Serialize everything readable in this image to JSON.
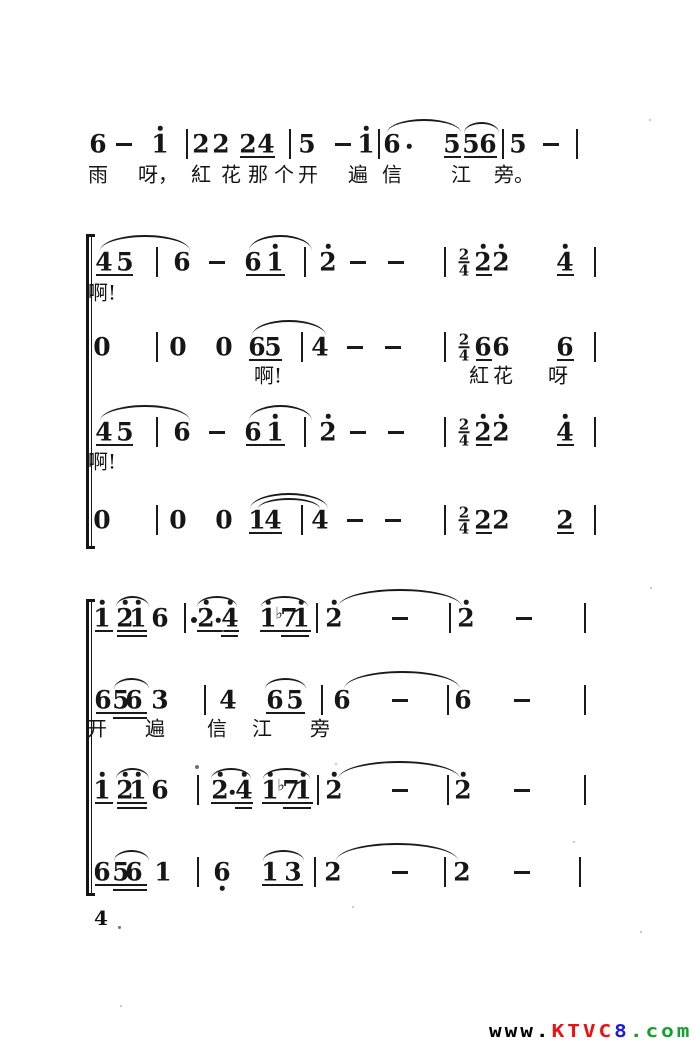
{
  "page": {
    "number": "4"
  },
  "colors": {
    "ink": "#1a1a1a",
    "paper": "#ffffff"
  },
  "watermark": {
    "segments": [
      {
        "text": "www.",
        "color": "#000000"
      },
      {
        "text": "KTVC",
        "color": "#ee1010"
      },
      {
        "text": "8",
        "color": "#1d1dd8"
      },
      {
        "text": ".com",
        "color": "#12a12e"
      }
    ]
  },
  "specks": [
    [
      118,
      926,
      3
    ],
    [
      195,
      765,
      4
    ],
    [
      649,
      119,
      2
    ],
    [
      335,
      763,
      2
    ],
    [
      650,
      587,
      2
    ],
    [
      222,
      630,
      2
    ],
    [
      352,
      906,
      2
    ],
    [
      573,
      841,
      2
    ],
    [
      120,
      1005,
      2
    ],
    [
      640,
      931,
      2
    ]
  ],
  "music": {
    "brackets": [
      {
        "x": 86,
        "y1": 236,
        "y2": 546
      },
      {
        "x": 86,
        "y1": 601,
        "y2": 893
      }
    ],
    "lines": [
      {
        "y": 144,
        "ly": 173,
        "tokens": [
          {
            "x": 98,
            "t": "6"
          },
          {
            "x": 124,
            "t": "-"
          },
          {
            "x": 160,
            "t": "1",
            "hi": 1
          },
          {
            "x": 187,
            "t": "|"
          },
          {
            "x": 201,
            "t": "2"
          },
          {
            "x": 221,
            "t": "2"
          },
          {
            "x": 248,
            "t": "2"
          },
          {
            "x": 266,
            "t": "4"
          },
          {
            "x": 290,
            "t": "|"
          },
          {
            "x": 307,
            "t": "5"
          },
          {
            "x": 343,
            "t": "-"
          },
          {
            "x": 366,
            "t": "1",
            "hi": 1
          },
          {
            "x": 379,
            "t": "|"
          },
          {
            "x": 392,
            "t": "6"
          },
          {
            "x": 409,
            "t": "."
          },
          {
            "x": 452,
            "t": "5"
          },
          {
            "x": 471,
            "t": "5"
          },
          {
            "x": 488,
            "t": "6"
          },
          {
            "x": 503,
            "t": "|"
          },
          {
            "x": 518,
            "t": "5"
          },
          {
            "x": 551,
            "t": "-"
          },
          {
            "x": 577,
            "t": "|"
          }
        ],
        "ul1": [
          [
            240,
            275
          ],
          [
            444,
            461
          ],
          [
            464,
            497
          ]
        ],
        "slurs": [
          [
            387,
            461,
            12
          ],
          [
            464,
            499,
            9
          ]
        ],
        "lyrics": [
          {
            "x": 98,
            "t": "雨"
          },
          {
            "x": 158,
            "t": "呀，"
          },
          {
            "x": 201,
            "t": "紅"
          },
          {
            "x": 231,
            "t": "花"
          },
          {
            "x": 258,
            "t": "那"
          },
          {
            "x": 284,
            "t": "个"
          },
          {
            "x": 308,
            "t": "开"
          },
          {
            "x": 358,
            "t": "遍"
          },
          {
            "x": 392,
            "t": "信"
          },
          {
            "x": 461,
            "t": "江"
          },
          {
            "x": 514,
            "t": "旁。"
          }
        ]
      },
      {
        "y": 262,
        "ly": 291,
        "tokens": [
          {
            "x": 104,
            "t": "4"
          },
          {
            "x": 125,
            "t": "5"
          },
          {
            "x": 157,
            "t": "|"
          },
          {
            "x": 182,
            "t": "6"
          },
          {
            "x": 217,
            "t": "-"
          },
          {
            "x": 253,
            "t": "6"
          },
          {
            "x": 275,
            "t": "1",
            "hi": 1
          },
          {
            "x": 305,
            "t": "|"
          },
          {
            "x": 328,
            "t": "2",
            "hi": 1
          },
          {
            "x": 358,
            "t": "-"
          },
          {
            "x": 396,
            "t": "-"
          },
          {
            "x": 445,
            "t": "|"
          },
          {
            "x": 464,
            "t": "ts",
            "top": "2",
            "bottom": "4"
          },
          {
            "x": 483,
            "t": "2",
            "hi": 1
          },
          {
            "x": 501,
            "t": "2",
            "hi": 1
          },
          {
            "x": 565,
            "t": "4",
            "hi": 1
          },
          {
            "x": 595,
            "t": "|"
          }
        ],
        "ul1": [
          [
            96,
            133
          ],
          [
            246,
            285
          ],
          [
            476,
            492
          ],
          [
            557,
            574
          ]
        ],
        "slurs": [
          [
            100,
            190,
            14
          ],
          [
            249,
            312,
            14
          ]
        ],
        "lyrics": [
          {
            "x": 102,
            "t": "啊!"
          }
        ]
      },
      {
        "y": 347,
        "ly": 374,
        "tokens": [
          {
            "x": 102,
            "t": "0"
          },
          {
            "x": 157,
            "t": "|"
          },
          {
            "x": 178,
            "t": "0"
          },
          {
            "x": 224,
            "t": "0"
          },
          {
            "x": 257,
            "t": "6"
          },
          {
            "x": 273,
            "t": "5"
          },
          {
            "x": 302,
            "t": "|"
          },
          {
            "x": 320,
            "t": "4"
          },
          {
            "x": 355,
            "t": "-"
          },
          {
            "x": 393,
            "t": "-"
          },
          {
            "x": 445,
            "t": "|"
          },
          {
            "x": 464,
            "t": "ts",
            "top": "2",
            "bottom": "4"
          },
          {
            "x": 483,
            "t": "6"
          },
          {
            "x": 501,
            "t": "6"
          },
          {
            "x": 565,
            "t": "6"
          },
          {
            "x": 595,
            "t": "|"
          }
        ],
        "ul1": [
          [
            249,
            282
          ],
          [
            476,
            492
          ],
          [
            557,
            574
          ]
        ],
        "slurs": [
          [
            252,
            326,
            14
          ]
        ],
        "lyrics": [
          {
            "x": 268,
            "t": "啊!"
          },
          {
            "x": 479,
            "t": "紅"
          },
          {
            "x": 503,
            "t": "花"
          },
          {
            "x": 558,
            "t": "呀"
          }
        ]
      },
      {
        "y": 432,
        "ly": 460,
        "tokens": [
          {
            "x": 104,
            "t": "4"
          },
          {
            "x": 125,
            "t": "5"
          },
          {
            "x": 157,
            "t": "|"
          },
          {
            "x": 182,
            "t": "6"
          },
          {
            "x": 217,
            "t": "-"
          },
          {
            "x": 253,
            "t": "6"
          },
          {
            "x": 275,
            "t": "1",
            "hi": 1
          },
          {
            "x": 305,
            "t": "|"
          },
          {
            "x": 328,
            "t": "2",
            "hi": 1
          },
          {
            "x": 358,
            "t": "-"
          },
          {
            "x": 396,
            "t": "-"
          },
          {
            "x": 445,
            "t": "|"
          },
          {
            "x": 464,
            "t": "ts",
            "top": "2",
            "bottom": "4"
          },
          {
            "x": 483,
            "t": "2",
            "hi": 1
          },
          {
            "x": 501,
            "t": "2",
            "hi": 1
          },
          {
            "x": 565,
            "t": "4",
            "hi": 1
          },
          {
            "x": 595,
            "t": "|"
          }
        ],
        "ul1": [
          [
            96,
            133
          ],
          [
            246,
            285
          ],
          [
            476,
            492
          ],
          [
            557,
            574
          ]
        ],
        "slurs": [
          [
            100,
            190,
            14
          ],
          [
            249,
            312,
            14
          ]
        ],
        "lyrics": [
          {
            "x": 102,
            "t": "啊!"
          }
        ]
      },
      {
        "y": 520,
        "tokens": [
          {
            "x": 102,
            "t": "0"
          },
          {
            "x": 157,
            "t": "|"
          },
          {
            "x": 178,
            "t": "0"
          },
          {
            "x": 224,
            "t": "0"
          },
          {
            "x": 257,
            "t": "1"
          },
          {
            "x": 273,
            "t": "4"
          },
          {
            "x": 302,
            "t": "|"
          },
          {
            "x": 320,
            "t": "4"
          },
          {
            "x": 355,
            "t": "-"
          },
          {
            "x": 393,
            "t": "-"
          },
          {
            "x": 445,
            "t": "|"
          },
          {
            "x": 464,
            "t": "ts",
            "top": "2",
            "bottom": "4"
          },
          {
            "x": 483,
            "t": "2"
          },
          {
            "x": 501,
            "t": "2"
          },
          {
            "x": 565,
            "t": "2"
          },
          {
            "x": 595,
            "t": "|"
          }
        ],
        "ul1": [
          [
            249,
            282
          ],
          [
            476,
            492
          ],
          [
            557,
            574
          ]
        ],
        "slurs": [
          [
            250,
            328,
            14
          ],
          [
            258,
            320,
            9
          ]
        ],
        "lyrics": []
      },
      {
        "y": 618,
        "tokens": [
          {
            "x": 102,
            "t": "1",
            "hi": 1
          },
          {
            "x": 125,
            "t": "2",
            "hi": 1
          },
          {
            "x": 138,
            "t": "1",
            "hi": 1
          },
          {
            "x": 160,
            "t": "6"
          },
          {
            "x": 185,
            "t": "|"
          },
          {
            "x": 194,
            "t": "*"
          },
          {
            "x": 206,
            "t": "2",
            "hi": 1
          },
          {
            "x": 218,
            "t": "."
          },
          {
            "x": 230,
            "t": "4",
            "hi": 1
          },
          {
            "x": 268,
            "t": "1",
            "hi": 1
          },
          {
            "x": 279,
            "t": "b",
            "glyph": "♭"
          },
          {
            "x": 289,
            "t": "7"
          },
          {
            "x": 301,
            "t": "1",
            "hi": 1
          },
          {
            "x": 317,
            "t": "|"
          },
          {
            "x": 334,
            "t": "2",
            "hi": 1
          },
          {
            "x": 400,
            "t": "-"
          },
          {
            "x": 450,
            "t": "|"
          },
          {
            "x": 466,
            "t": "2",
            "hi": 1
          },
          {
            "x": 524,
            "t": "-"
          },
          {
            "x": 585,
            "t": "|"
          }
        ],
        "ul1": [
          [
            95,
            113
          ],
          [
            117,
            147
          ],
          [
            197,
            239
          ],
          [
            260,
            311
          ]
        ],
        "ul2": [
          [
            117,
            147
          ],
          [
            221,
            238
          ],
          [
            281,
            309
          ]
        ],
        "slurs": [
          [
            116,
            149,
            9
          ],
          [
            197,
            237,
            9
          ],
          [
            261,
            308,
            9
          ],
          [
            338,
            462,
            16
          ]
        ],
        "lyrics": []
      },
      {
        "y": 700,
        "ly": 727,
        "tokens": [
          {
            "x": 103,
            "t": "6"
          },
          {
            "x": 121,
            "t": "5"
          },
          {
            "x": 134,
            "t": "6"
          },
          {
            "x": 160,
            "t": "3"
          },
          {
            "x": 205,
            "t": "|"
          },
          {
            "x": 228,
            "t": "4"
          },
          {
            "x": 275,
            "t": "6"
          },
          {
            "x": 295,
            "t": "5"
          },
          {
            "x": 322,
            "t": "|"
          },
          {
            "x": 342,
            "t": "6"
          },
          {
            "x": 400,
            "t": "-"
          },
          {
            "x": 448,
            "t": "|"
          },
          {
            "x": 463,
            "t": "6"
          },
          {
            "x": 522,
            "t": "-"
          },
          {
            "x": 585,
            "t": "|"
          }
        ],
        "ul1": [
          [
            96,
            147
          ],
          [
            266,
            305
          ]
        ],
        "ul2": [
          [
            113,
            147
          ]
        ],
        "slurs": [
          [
            114,
            149,
            9
          ],
          [
            265,
            306,
            9
          ],
          [
            344,
            460,
            16
          ]
        ],
        "lyrics": [
          {
            "x": 97,
            "t": "开"
          },
          {
            "x": 155,
            "t": "遍"
          },
          {
            "x": 217,
            "t": "信"
          },
          {
            "x": 262,
            "t": "江"
          },
          {
            "x": 320,
            "t": "旁"
          }
        ]
      },
      {
        "y": 790,
        "tokens": [
          {
            "x": 102,
            "t": "1",
            "hi": 1
          },
          {
            "x": 125,
            "t": "2",
            "hi": 1
          },
          {
            "x": 138,
            "t": "1",
            "hi": 1
          },
          {
            "x": 160,
            "t": "6"
          },
          {
            "x": 198,
            "t": "|"
          },
          {
            "x": 220,
            "t": "2",
            "hi": 1
          },
          {
            "x": 232,
            "t": "."
          },
          {
            "x": 244,
            "t": "4",
            "hi": 1
          },
          {
            "x": 270,
            "t": "1",
            "hi": 1
          },
          {
            "x": 281,
            "t": "b",
            "glyph": "♭"
          },
          {
            "x": 291,
            "t": "7"
          },
          {
            "x": 303,
            "t": "1",
            "hi": 1
          },
          {
            "x": 318,
            "t": "|"
          },
          {
            "x": 334,
            "t": "2",
            "hi": 1
          },
          {
            "x": 400,
            "t": "-"
          },
          {
            "x": 448,
            "t": "|"
          },
          {
            "x": 463,
            "t": "2",
            "hi": 1
          },
          {
            "x": 522,
            "t": "-"
          },
          {
            "x": 585,
            "t": "|"
          }
        ],
        "ul1": [
          [
            95,
            113
          ],
          [
            117,
            147
          ],
          [
            211,
            253
          ],
          [
            262,
            313
          ]
        ],
        "ul2": [
          [
            117,
            147
          ],
          [
            235,
            252
          ],
          [
            283,
            311
          ]
        ],
        "slurs": [
          [
            116,
            149,
            9
          ],
          [
            211,
            251,
            9
          ],
          [
            263,
            310,
            9
          ],
          [
            338,
            460,
            16
          ]
        ],
        "lyrics": []
      },
      {
        "y": 872,
        "tokens": [
          {
            "x": 102,
            "t": "6"
          },
          {
            "x": 121,
            "t": "5"
          },
          {
            "x": 134,
            "t": "6"
          },
          {
            "x": 163,
            "t": "1"
          },
          {
            "x": 198,
            "t": "|"
          },
          {
            "x": 222,
            "t": "6",
            "lo": 1
          },
          {
            "x": 270,
            "t": "1"
          },
          {
            "x": 293,
            "t": "3"
          },
          {
            "x": 315,
            "t": "|"
          },
          {
            "x": 333,
            "t": "2"
          },
          {
            "x": 400,
            "t": "-"
          },
          {
            "x": 445,
            "t": "|"
          },
          {
            "x": 462,
            "t": "2"
          },
          {
            "x": 522,
            "t": "-"
          },
          {
            "x": 580,
            "t": "|"
          }
        ],
        "ul1": [
          [
            95,
            147
          ],
          [
            262,
            303
          ]
        ],
        "ul2": [
          [
            113,
            147
          ]
        ],
        "slurs": [
          [
            114,
            149,
            9
          ],
          [
            263,
            304,
            9
          ],
          [
            336,
            458,
            16
          ]
        ],
        "lyrics": []
      }
    ]
  }
}
